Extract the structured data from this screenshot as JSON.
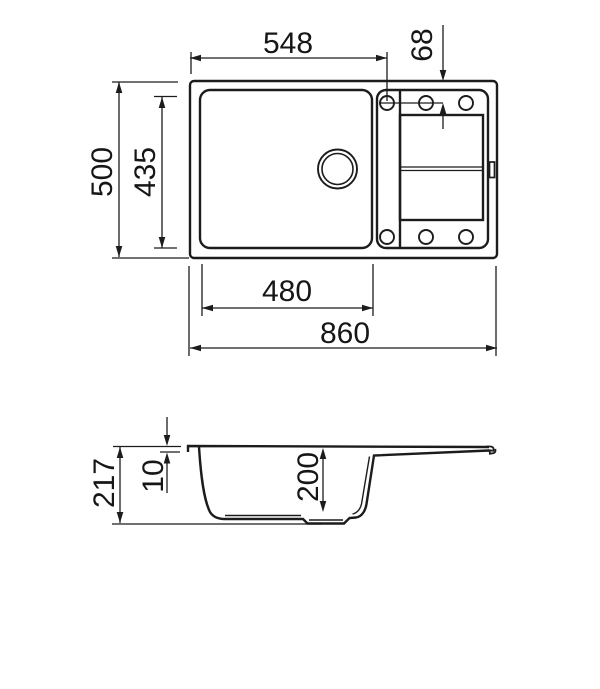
{
  "drawing": {
    "kind": "sink-technical-drawing",
    "top_view": {
      "overall_width": "860",
      "overall_depth": "500",
      "bowl_width": "480",
      "bowl_depth": "435",
      "tap_hole_from_left": "548",
      "tap_hole_from_top": "68"
    },
    "side_view": {
      "overall_height": "217",
      "rim_height": "10",
      "bowl_inner_depth": "200"
    }
  }
}
